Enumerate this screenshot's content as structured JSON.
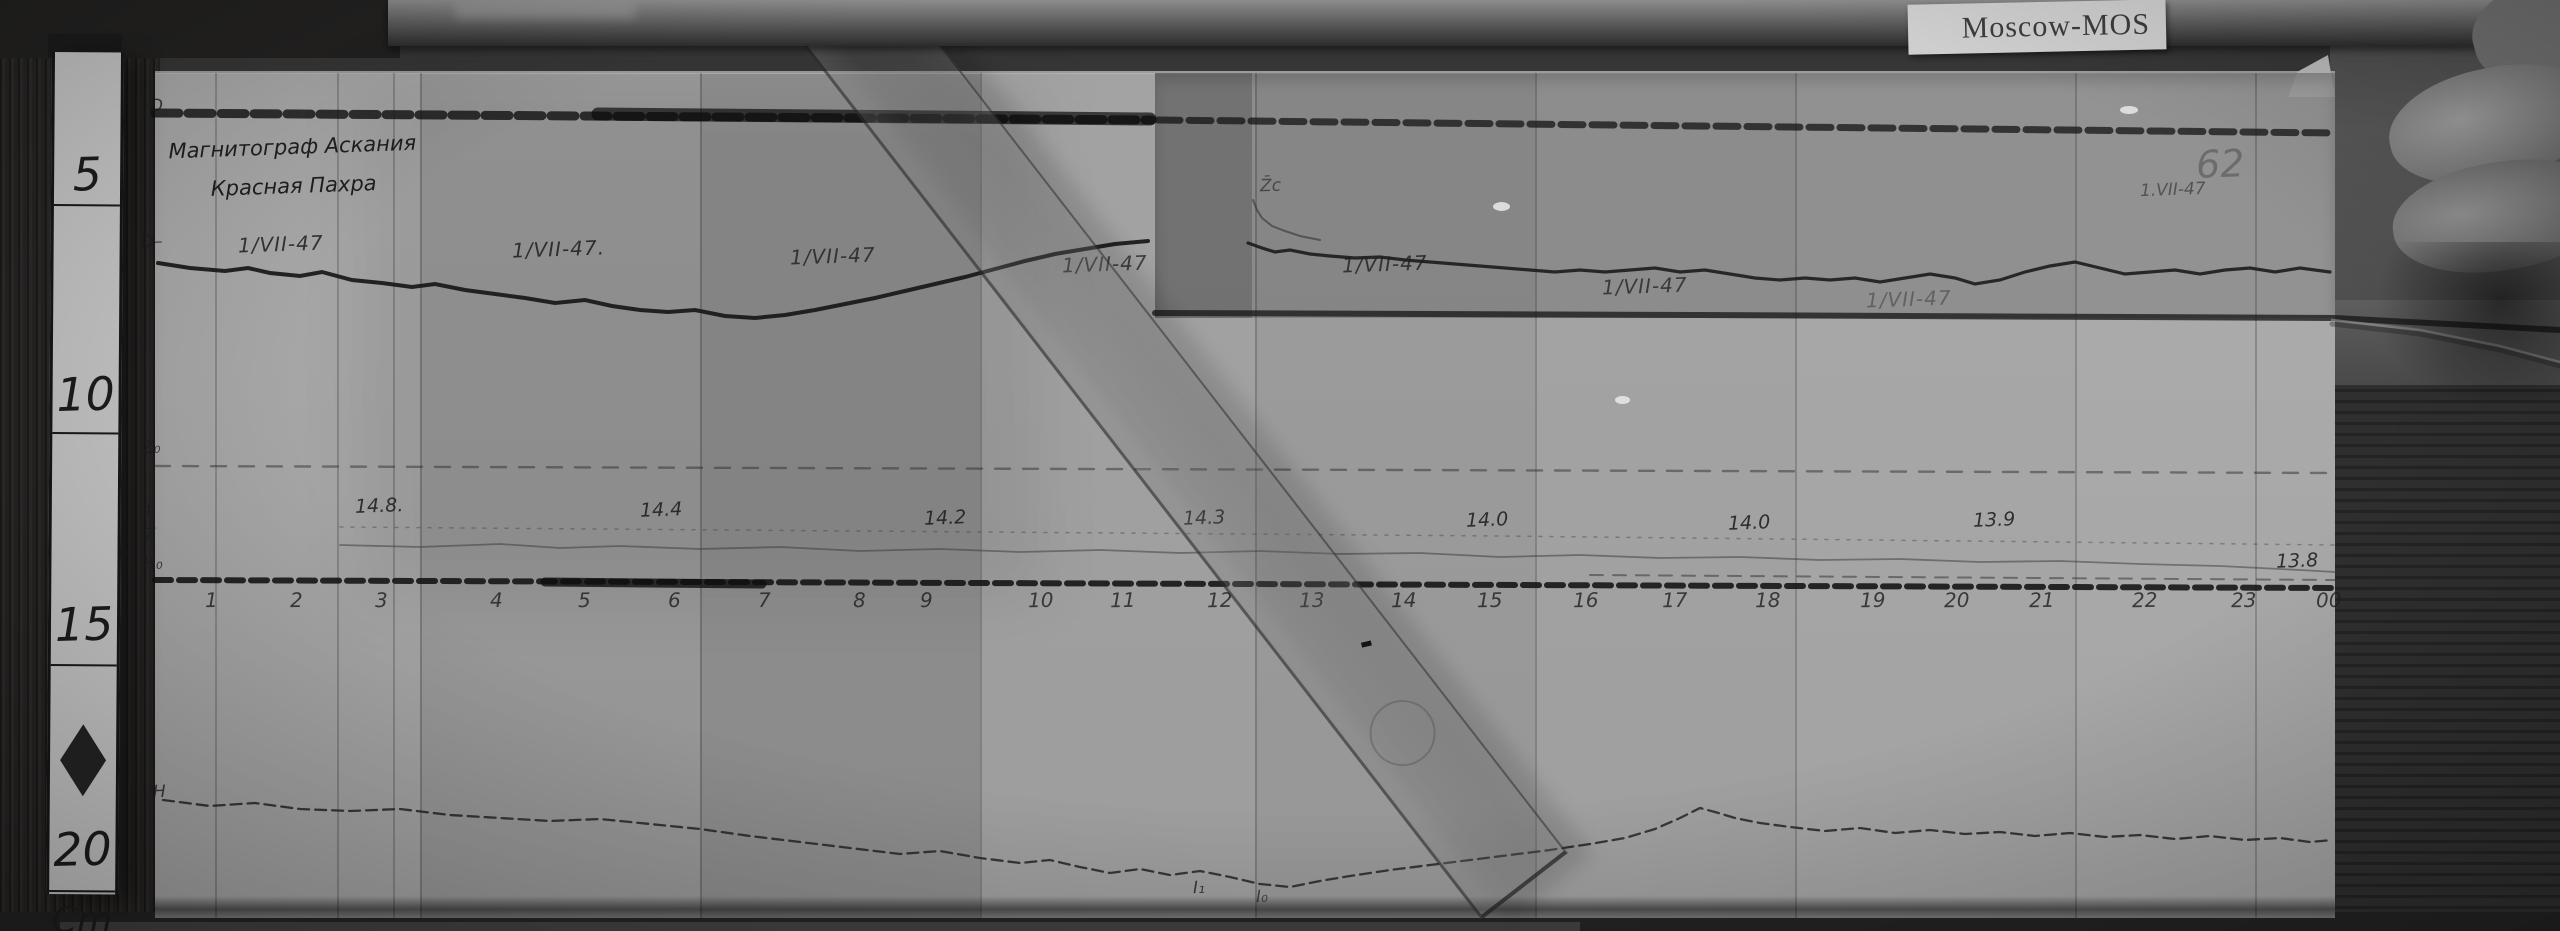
{
  "scene": {
    "label_tag": "Moscow-MOS",
    "ruler": {
      "unit": "Cm",
      "unit_y": 848,
      "diamond_y": 672,
      "marks": [
        {
          "label": "5",
          "num_y": 95,
          "line_y": 152
        },
        {
          "label": "10",
          "num_y": 315,
          "line_y": 380
        },
        {
          "label": "15",
          "num_y": 545,
          "line_y": 612
        },
        {
          "label": "20",
          "num_y": 770,
          "line_y": 838
        }
      ]
    }
  },
  "sheet": {
    "header": {
      "line1": "Магнитограф Аскания",
      "line2": "Красная Пахра"
    },
    "trace_labels": [
      {
        "text": "D",
        "x": 150,
        "y": 96,
        "opacity": 0.8
      },
      {
        "text": "D–",
        "x": 141,
        "y": 232,
        "opacity": 0.75
      },
      {
        "text": "Z₀",
        "x": 142,
        "y": 438,
        "opacity": 0.75
      },
      {
        "text": "t",
        "x": 146,
        "y": 500,
        "opacity": 0.7
      },
      {
        "text": "Z",
        "x": 144,
        "y": 525,
        "opacity": 0.65
      },
      {
        "text": "H₀",
        "x": 143,
        "y": 554,
        "opacity": 0.8
      },
      {
        "text": "H",
        "x": 153,
        "y": 782,
        "opacity": 0.8
      }
    ],
    "overlay_note": {
      "text": "Z̄c",
      "x": 1260,
      "y": 176,
      "opacity": 0.6
    },
    "dates": [
      {
        "text": "1/VII-47",
        "x": 238,
        "y": 232,
        "opacity": 0.85
      },
      {
        "text": "1/VII-47.",
        "x": 512,
        "y": 237,
        "opacity": 0.85
      },
      {
        "text": "1/VII-47",
        "x": 790,
        "y": 244,
        "opacity": 0.8
      },
      {
        "text": "1/VII-47",
        "x": 1062,
        "y": 252,
        "opacity": 0.75
      },
      {
        "text": "1/VII-47",
        "x": 1342,
        "y": 252,
        "opacity": 0.8
      },
      {
        "text": "1/VII-47",
        "x": 1602,
        "y": 274,
        "opacity": 0.75
      },
      {
        "text": "1/VII-47",
        "x": 1866,
        "y": 287,
        "opacity": 0.4
      }
    ],
    "corner_notes": [
      {
        "text": "62",
        "x": 2196,
        "y": 142,
        "size": 38,
        "opacity": 0.32
      },
      {
        "text": "1.VII-47",
        "x": 2140,
        "y": 180,
        "size": 17,
        "opacity": 0.55
      }
    ],
    "values": [
      {
        "text": "14.8.",
        "x": 355,
        "y": 495
      },
      {
        "text": "14.4",
        "x": 640,
        "y": 499
      },
      {
        "text": "14.2",
        "x": 924,
        "y": 507
      },
      {
        "text": "14.3",
        "x": 1183,
        "y": 507
      },
      {
        "text": "14.0",
        "x": 1466,
        "y": 509
      },
      {
        "text": "14.0",
        "x": 1728,
        "y": 512
      },
      {
        "text": "13.9",
        "x": 1973,
        "y": 509
      },
      {
        "text": "13.8",
        "x": 2276,
        "y": 550
      }
    ],
    "hours": [
      {
        "label": "1",
        "x": 205
      },
      {
        "label": "2",
        "x": 290
      },
      {
        "label": "3",
        "x": 375
      },
      {
        "label": "4",
        "x": 490
      },
      {
        "label": "5",
        "x": 578
      },
      {
        "label": "6",
        "x": 668
      },
      {
        "label": "7",
        "x": 758
      },
      {
        "label": "8",
        "x": 853
      },
      {
        "label": "9",
        "x": 920
      },
      {
        "label": "10",
        "x": 1028
      },
      {
        "label": "11",
        "x": 1110
      },
      {
        "label": "12",
        "x": 1207
      },
      {
        "label": "13",
        "x": 1299
      },
      {
        "label": "14",
        "x": 1391
      },
      {
        "label": "15",
        "x": 1477
      },
      {
        "label": "16",
        "x": 1573
      },
      {
        "label": "17",
        "x": 1662
      },
      {
        "label": "18",
        "x": 1755
      },
      {
        "label": "19",
        "x": 1860
      },
      {
        "label": "20",
        "x": 1944
      },
      {
        "label": "21",
        "x": 2029
      },
      {
        "label": "22",
        "x": 2132
      },
      {
        "label": "23",
        "x": 2231
      },
      {
        "label": "00",
        "x": 2316
      }
    ],
    "hours_y": 588,
    "bottom_notes": [
      {
        "text": "I₁",
        "x": 1193,
        "y": 878,
        "opacity": 0.8
      },
      {
        "text": "I₀",
        "x": 1256,
        "y": 887,
        "opacity": 0.7
      }
    ]
  },
  "traces": {
    "top_band": [
      [
        155,
        113
      ],
      [
        1152,
        120
      ]
    ],
    "top_band_blob": [
      [
        598,
        114
      ],
      [
        1150,
        119
      ]
    ],
    "overlay_band": [
      [
        1158,
        120
      ],
      [
        2335,
        133
      ]
    ],
    "d_main": [
      [
        158,
        263
      ],
      [
        190,
        268
      ],
      [
        225,
        271
      ],
      [
        248,
        268
      ],
      [
        270,
        273
      ],
      [
        300,
        276
      ],
      [
        322,
        272
      ],
      [
        352,
        280
      ],
      [
        382,
        283
      ],
      [
        412,
        287
      ],
      [
        435,
        284
      ],
      [
        465,
        290
      ],
      [
        495,
        294
      ],
      [
        525,
        298
      ],
      [
        555,
        303
      ],
      [
        585,
        300
      ],
      [
        612,
        306
      ],
      [
        640,
        310
      ],
      [
        668,
        312
      ],
      [
        695,
        310
      ],
      [
        725,
        316
      ],
      [
        755,
        318
      ],
      [
        785,
        315
      ],
      [
        815,
        310
      ],
      [
        845,
        304
      ],
      [
        875,
        298
      ],
      [
        905,
        291
      ],
      [
        935,
        284
      ],
      [
        965,
        277
      ],
      [
        995,
        269
      ],
      [
        1025,
        261
      ],
      [
        1055,
        254
      ],
      [
        1085,
        249
      ],
      [
        1115,
        244
      ],
      [
        1148,
        241
      ]
    ],
    "squiggle": [
      [
        1253,
        200
      ],
      [
        1257,
        210
      ],
      [
        1262,
        218
      ],
      [
        1272,
        226
      ],
      [
        1285,
        231
      ],
      [
        1300,
        236
      ],
      [
        1320,
        240
      ]
    ],
    "d_overlay": [
      [
        1248,
        243
      ],
      [
        1262,
        248
      ],
      [
        1275,
        252
      ],
      [
        1290,
        250
      ],
      [
        1310,
        254
      ],
      [
        1330,
        256
      ],
      [
        1355,
        258
      ],
      [
        1380,
        257
      ],
      [
        1405,
        260
      ],
      [
        1430,
        262
      ],
      [
        1455,
        264
      ],
      [
        1480,
        266
      ],
      [
        1505,
        268
      ],
      [
        1530,
        270
      ],
      [
        1555,
        272
      ],
      [
        1580,
        270
      ],
      [
        1605,
        272
      ],
      [
        1630,
        270
      ],
      [
        1655,
        268
      ],
      [
        1680,
        272
      ],
      [
        1705,
        270
      ],
      [
        1730,
        274
      ],
      [
        1755,
        278
      ],
      [
        1780,
        280
      ],
      [
        1805,
        278
      ],
      [
        1830,
        280
      ],
      [
        1855,
        278
      ],
      [
        1880,
        282
      ],
      [
        1905,
        278
      ],
      [
        1930,
        274
      ],
      [
        1955,
        278
      ],
      [
        1975,
        284
      ],
      [
        2000,
        280
      ],
      [
        2025,
        272
      ],
      [
        2050,
        266
      ],
      [
        2075,
        262
      ],
      [
        2100,
        268
      ],
      [
        2125,
        274
      ],
      [
        2150,
        272
      ],
      [
        2175,
        270
      ],
      [
        2200,
        274
      ],
      [
        2225,
        270
      ],
      [
        2250,
        268
      ],
      [
        2275,
        272
      ],
      [
        2300,
        268
      ],
      [
        2330,
        272
      ]
    ],
    "overlay_edge": [
      [
        1155,
        313
      ],
      [
        1700,
        315
      ],
      [
        2335,
        318
      ],
      [
        2560,
        330
      ]
    ],
    "z0_line": [
      [
        155,
        466
      ],
      [
        2335,
        473
      ]
    ],
    "t_line": [
      [
        340,
        527
      ],
      [
        1500,
        536
      ],
      [
        2335,
        545
      ]
    ],
    "z_wavy": [
      [
        340,
        545
      ],
      [
        420,
        547
      ],
      [
        500,
        544
      ],
      [
        560,
        548
      ],
      [
        620,
        546
      ],
      [
        700,
        549
      ],
      [
        780,
        547
      ],
      [
        860,
        551
      ],
      [
        940,
        549
      ],
      [
        1020,
        552
      ],
      [
        1100,
        550
      ],
      [
        1180,
        553
      ],
      [
        1260,
        551
      ],
      [
        1340,
        554
      ],
      [
        1420,
        553
      ],
      [
        1500,
        557
      ],
      [
        1580,
        555
      ],
      [
        1660,
        558
      ],
      [
        1740,
        557
      ],
      [
        1820,
        560
      ],
      [
        1900,
        559
      ],
      [
        1980,
        562
      ],
      [
        2060,
        561
      ],
      [
        2140,
        564
      ],
      [
        2220,
        566
      ],
      [
        2300,
        570
      ],
      [
        2335,
        572
      ]
    ],
    "h0_line": [
      [
        155,
        580
      ],
      [
        2335,
        588
      ]
    ],
    "h0_dark": [
      [
        545,
        582
      ],
      [
        762,
        584
      ]
    ],
    "h0_thin_right": [
      [
        1590,
        575
      ],
      [
        2335,
        580
      ]
    ],
    "h_trace": [
      [
        163,
        800
      ],
      [
        210,
        806
      ],
      [
        255,
        803
      ],
      [
        300,
        809
      ],
      [
        350,
        811
      ],
      [
        400,
        809
      ],
      [
        450,
        815
      ],
      [
        500,
        818
      ],
      [
        550,
        821
      ],
      [
        600,
        819
      ],
      [
        650,
        824
      ],
      [
        700,
        829
      ],
      [
        750,
        836
      ],
      [
        800,
        842
      ],
      [
        850,
        848
      ],
      [
        900,
        854
      ],
      [
        940,
        851
      ],
      [
        980,
        858
      ],
      [
        1020,
        863
      ],
      [
        1050,
        860
      ],
      [
        1080,
        867
      ],
      [
        1110,
        873
      ],
      [
        1140,
        869
      ],
      [
        1170,
        875
      ],
      [
        1200,
        871
      ],
      [
        1230,
        877
      ],
      [
        1260,
        884
      ],
      [
        1290,
        887
      ],
      [
        1320,
        881
      ],
      [
        1350,
        876
      ],
      [
        1390,
        870
      ],
      [
        1430,
        865
      ],
      [
        1470,
        860
      ],
      [
        1510,
        855
      ],
      [
        1550,
        850
      ],
      [
        1590,
        844
      ],
      [
        1625,
        838
      ],
      [
        1655,
        829
      ],
      [
        1680,
        818
      ],
      [
        1700,
        808
      ],
      [
        1715,
        812
      ],
      [
        1735,
        818
      ],
      [
        1760,
        823
      ],
      [
        1790,
        827
      ],
      [
        1825,
        831
      ],
      [
        1860,
        828
      ],
      [
        1895,
        833
      ],
      [
        1930,
        830
      ],
      [
        1965,
        834
      ],
      [
        2000,
        832
      ],
      [
        2035,
        836
      ],
      [
        2070,
        833
      ],
      [
        2105,
        837
      ],
      [
        2140,
        835
      ],
      [
        2175,
        839
      ],
      [
        2210,
        836
      ],
      [
        2245,
        840
      ],
      [
        2280,
        838
      ],
      [
        2310,
        842
      ],
      [
        2332,
        840
      ]
    ],
    "glass_curve": [
      [
        2332,
        320
      ],
      [
        2420,
        330
      ],
      [
        2500,
        346
      ],
      [
        2560,
        362
      ]
    ],
    "glass_curve_sh": [
      [
        2332,
        324
      ],
      [
        2420,
        334
      ],
      [
        2500,
        350
      ],
      [
        2560,
        366
      ]
    ]
  },
  "layout_panels": [
    {
      "x": 155,
      "w": 265,
      "shade": "#a8a8a8"
    },
    {
      "x": 420,
      "w": 280,
      "shade": "#9b9b9b"
    },
    {
      "x": 700,
      "w": 280,
      "shade": "#909090"
    },
    {
      "x": 980,
      "w": 275,
      "shade": "#a3a3a3"
    },
    {
      "x": 1255,
      "w": 280,
      "shade": "#9d9d9d"
    },
    {
      "x": 1535,
      "w": 260,
      "shade": "#a5a5a5"
    },
    {
      "x": 1795,
      "w": 280,
      "shade": "#a9a9a9"
    },
    {
      "x": 2075,
      "w": 260,
      "shade": "#acacac"
    }
  ],
  "layout_seams": [
    215,
    337,
    393,
    420,
    700,
    980,
    1255,
    1535,
    1795,
    2075,
    2255
  ]
}
